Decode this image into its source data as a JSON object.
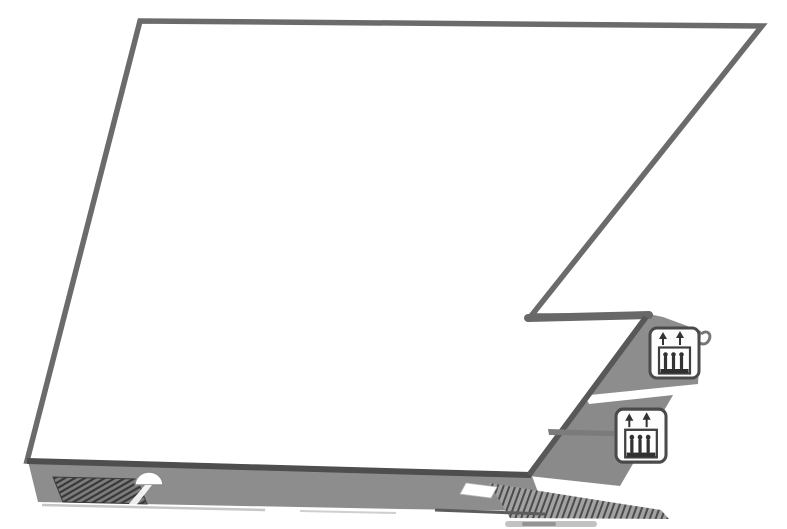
{
  "diagram": {
    "kind": "building-floor-plan",
    "background": "#ffffff",
    "text_content": "none"
  },
  "colors": {
    "floor_fill": "#ffffff",
    "outline": "#6b6b6b",
    "outline_dark": "#4e4e4e",
    "outline_diag": "#585858",
    "band": "#8d8d8d",
    "band_lower": "#8a8a8a",
    "band_edge_dark": "#5c5c5c",
    "vent_fill": "#7d7d7d",
    "vent_stripe": "#383838",
    "stairs_fill": "#a2a2a2",
    "stairs_stripe": "#4c4c4c",
    "gap_white": "#ffffff",
    "arch_fill": "#ffffff",
    "arch_stroke": "#8a8a8a",
    "icon_bg": "#fdfdfd",
    "icon_border": "#4a4a4a",
    "icon_glyph": "#333333",
    "hook_stroke": "#777777",
    "shadow_light": "#c6c6c6",
    "smudge": "#8f8f8f",
    "connector_line": "#7b7b7b"
  },
  "icons": {
    "elevator_upper": {
      "name": "elevator-icon"
    },
    "elevator_lower": {
      "name": "elevator-icon"
    }
  }
}
